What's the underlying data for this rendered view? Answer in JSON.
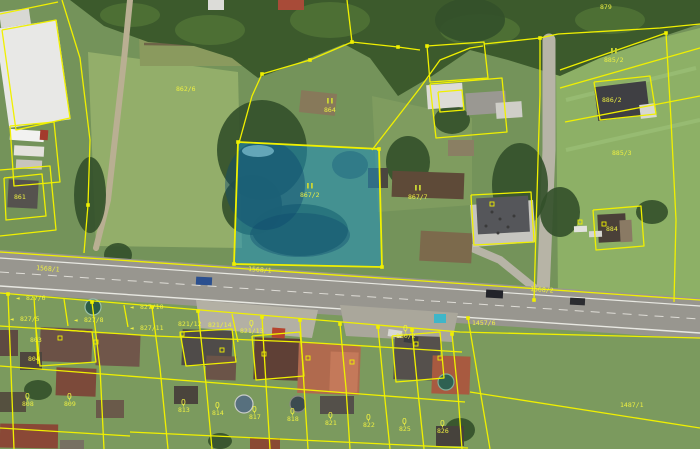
{
  "meta": {
    "view": "aerial-orthophoto-with-cadastral-overlay",
    "width": 700,
    "height": 449
  },
  "map": {
    "w": 700,
    "h": 449,
    "base": "#74935a",
    "palette": {
      "cadastral_yellow": "#f0f000",
      "highlight_blue": "#1d8fc0",
      "label_yellow": "#eef041",
      "symbol_green": "#c9d435",
      "road_gray": "#98968f"
    },
    "fields": [
      {
        "pts": "88,52 238,72 242,248 96,246",
        "fill": "#93ae6a"
      },
      {
        "pts": "556,64 700,28 700,300 558,300",
        "fill": "#8db066"
      },
      {
        "pts": "460,338 700,340 700,449 486,449",
        "fill": "#80ad5a"
      },
      {
        "pts": "0,290 700,336 700,449 0,449",
        "fill": "#7b9a5e"
      },
      {
        "pts": "372,96 472,118 472,205 378,212",
        "fill": "#7f9c5f"
      },
      {
        "pts": "138,0 290,0 290,66 140,66",
        "fill": "#8a9a5e"
      }
    ],
    "strips": [
      {
        "pts": "142,10 288,16",
        "stroke": "#6e6448",
        "w": 2.5
      },
      {
        "pts": "142,26 288,30",
        "stroke": "#6e6448",
        "w": 2.5
      },
      {
        "pts": "144,44 288,46",
        "stroke": "#6e6448",
        "w": 2.5
      },
      {
        "pts": "566,100 696,68",
        "stroke": "#97bb72",
        "w": 4
      },
      {
        "pts": "566,150 700,120",
        "stroke": "#97bb72",
        "w": 4
      }
    ],
    "paths": [
      {
        "pts": "130,0 124,60 116,130 108,200 96,248",
        "stroke": "#b9af92",
        "w": 6
      },
      {
        "pts": "549,40 549,150 543,295",
        "stroke": "#b7b4a6",
        "w": 13
      },
      {
        "pts": "543,295 500,260 472,248",
        "stroke": "#b7b4a6",
        "w": 8
      }
    ],
    "forest": {
      "pts": "70,0 700,0 700,24 652,40 600,58 560,76 508,60 470,50 432,76 398,96 370,58 344,44 300,62 258,78 232,58 194,46 148,42 104,26",
      "fill": "#3c5a2c",
      "canopy": [
        [
          130,
          15,
          30,
          12
        ],
        [
          210,
          30,
          35,
          15
        ],
        [
          330,
          20,
          40,
          18
        ],
        [
          480,
          30,
          40,
          16
        ],
        [
          610,
          20,
          35,
          14
        ]
      ],
      "blobs": [
        [
          262,
          150,
          45,
          50
        ],
        [
          300,
          230,
          48,
          26
        ],
        [
          252,
          205,
          30,
          30
        ],
        [
          408,
          162,
          22,
          26
        ],
        [
          452,
          120,
          18,
          14
        ],
        [
          520,
          185,
          28,
          42
        ],
        [
          560,
          212,
          20,
          25
        ],
        [
          470,
          20,
          35,
          22
        ],
        [
          90,
          195,
          16,
          38
        ],
        [
          118,
          255,
          14,
          12
        ],
        [
          420,
          310,
          25,
          14
        ],
        [
          340,
          302,
          15,
          9
        ],
        [
          460,
          430,
          15,
          12
        ],
        [
          220,
          441,
          12,
          8
        ],
        [
          38,
          390,
          14,
          10
        ],
        [
          652,
          212,
          16,
          12
        ]
      ]
    },
    "road": {
      "pts": "0,250 700,298 700,339 0,293",
      "fill": "#98968f",
      "lines": [
        {
          "pts": "0,258 700,306",
          "color": "#e8e8e2",
          "w": 1.2
        },
        {
          "pts": "0,286 700,333",
          "color": "#e8e8e2",
          "w": 1.4
        },
        {
          "pts": "0,272 700,319",
          "color": "#dedcd6",
          "w": 1,
          "dash": "9,7"
        }
      ]
    },
    "pavements": [
      {
        "pts": "196,300 318,310 312,338 200,328",
        "fill": "#b3b0a4"
      },
      {
        "pts": "340,305 458,313 452,342 346,336",
        "fill": "#aaa79b"
      },
      {
        "pts": "470,205 533,200 536,242 473,247",
        "fill": "#c6c5c0"
      }
    ],
    "soil": [
      [
        420,
        232,
        52,
        30,
        "#7c6a4c",
        3
      ],
      [
        300,
        92,
        36,
        22,
        "#87795a",
        6
      ],
      [
        448,
        140,
        26,
        16,
        "#8a7f63",
        0
      ]
    ],
    "buildings": [
      [
        2,
        24,
        62,
        100,
        "#e8e8e6",
        -8
      ],
      [
        0,
        10,
        30,
        16,
        "#d8d8d4",
        -8
      ],
      [
        8,
        180,
        30,
        28,
        "#55524e",
        3
      ],
      [
        278,
        0,
        26,
        10,
        "#a84b38",
        0
      ],
      [
        208,
        0,
        16,
        10,
        "#dcdcd8",
        0
      ],
      [
        427,
        84,
        36,
        24,
        "#dddcd6",
        -4
      ],
      [
        466,
        92,
        40,
        22,
        "#9a9892",
        -4
      ],
      [
        496,
        102,
        26,
        16,
        "#cfcec8",
        -4
      ],
      [
        368,
        168,
        20,
        20,
        "#4a463f",
        0
      ],
      [
        392,
        172,
        72,
        26,
        "#5e4a38",
        2
      ],
      [
        477,
        197,
        52,
        36,
        "#55565a",
        -3
      ],
      [
        596,
        84,
        52,
        34,
        "#3f3f43",
        -7
      ],
      [
        640,
        104,
        16,
        14,
        "#d8d8d2",
        -7
      ],
      [
        598,
        214,
        28,
        28,
        "#4a4038",
        -3
      ],
      [
        620,
        220,
        12,
        22,
        "#8a7a64",
        -3
      ],
      [
        40,
        328,
        52,
        34,
        "#6b5146",
        2
      ],
      [
        0,
        330,
        18,
        26,
        "#5e4a42",
        0
      ],
      [
        96,
        334,
        44,
        32,
        "#70564a",
        2
      ],
      [
        56,
        368,
        40,
        28,
        "#7c4a3a",
        2
      ],
      [
        20,
        352,
        22,
        18,
        "#4e463e",
        0
      ],
      [
        182,
        330,
        50,
        36,
        "#4f4b49",
        2
      ],
      [
        206,
        356,
        30,
        24,
        "#6b5448",
        2
      ],
      [
        254,
        338,
        46,
        42,
        "#5f4036",
        2
      ],
      [
        298,
        344,
        62,
        50,
        "#b06a4e",
        2
      ],
      [
        330,
        352,
        28,
        40,
        "#c4795a",
        2
      ],
      [
        394,
        336,
        46,
        44,
        "#55504c",
        2
      ],
      [
        432,
        356,
        38,
        38,
        "#a85a40",
        2
      ],
      [
        174,
        386,
        24,
        18,
        "#4a443c",
        0
      ],
      [
        320,
        396,
        34,
        18,
        "#54504a",
        0
      ],
      [
        250,
        438,
        30,
        11,
        "#8a4a34",
        0
      ],
      [
        436,
        426,
        28,
        20,
        "#46423c",
        0
      ],
      [
        96,
        400,
        28,
        18,
        "#6a5a4a",
        0
      ],
      [
        0,
        392,
        26,
        20,
        "#55503f",
        0
      ],
      [
        0,
        424,
        58,
        24,
        "#8a4836",
        1
      ],
      [
        60,
        440,
        24,
        9,
        "#777062",
        0
      ],
      [
        272,
        328,
        13,
        10,
        "#b5442e",
        4
      ],
      [
        434,
        314,
        12,
        9,
        "#3fb6c9",
        0
      ]
    ],
    "circles": [
      [
        93,
        307,
        8,
        "#2e5d46",
        "#9ac0a8"
      ],
      [
        244,
        404,
        9,
        "#57707e",
        "#c9ccc9"
      ],
      [
        298,
        404,
        8,
        "#3c4a50",
        "#888880"
      ],
      [
        446,
        382,
        8,
        "#2f6152",
        "#7fae99"
      ]
    ],
    "vehicles": [
      [
        196,
        277,
        16,
        8,
        "#2a4f8f",
        3
      ],
      [
        486,
        290,
        17,
        8,
        "#23242a",
        3
      ],
      [
        570,
        298,
        15,
        7,
        "#2b2c30",
        3
      ],
      [
        388,
        330,
        14,
        7,
        "#d8d8d4",
        8
      ],
      [
        404,
        336,
        14,
        7,
        "#3a3b40",
        8
      ],
      [
        574,
        226,
        13,
        6,
        "#e2e2de",
        -2
      ],
      [
        589,
        231,
        13,
        6,
        "#d6d6d0",
        -2
      ],
      [
        10,
        130,
        34,
        11,
        "#f2f2f0",
        4
      ],
      [
        14,
        146,
        30,
        10,
        "#e4e2dc",
        3
      ],
      [
        16,
        160,
        26,
        9,
        "#c8c4bc",
        3
      ],
      [
        40,
        130,
        8,
        10,
        "#a33b2c",
        4
      ]
    ],
    "people": [
      [
        492,
        212
      ],
      [
        500,
        219
      ],
      [
        508,
        227
      ],
      [
        514,
        216
      ],
      [
        498,
        233
      ],
      [
        486,
        226
      ]
    ],
    "highlight": {
      "pts": "238,142 379,149 382,267 234,264",
      "fill": "#1d8fc0",
      "opacity": 0.55,
      "stroke": "#f0f000",
      "blobs": [
        [
          265,
          185,
          40,
          45,
          "#0e4a6e",
          0.45
        ],
        [
          300,
          235,
          50,
          22,
          "#0e4a6e",
          0.4
        ],
        [
          350,
          165,
          18,
          14,
          "#0f5478",
          0.35
        ],
        [
          258,
          151,
          16,
          6,
          "#9fe0ee",
          0.55
        ]
      ]
    },
    "cadastral": {
      "color": "#f0f000",
      "width": 1.3,
      "lines": [
        "62,0 80,58 90,140 88,205 84,253",
        "0,14 58,2",
        "2,30 56,20 70,118 16,130 2,30",
        "10,126 54,122 60,182 14,186 10,126",
        "0,170 50,166 56,230 0,236",
        "4,178 42,174 46,216 6,220 4,178",
        "0,252 700,300",
        "0,293 460,332 700,338",
        "239,143 252,96 262,74 310,60 352,42 398,47 420,50",
        "372,150 420,88 440,60 470,48 483,46",
        "352,42 347,0",
        "427,46 484,42 488,78 430,82 427,46",
        "430,84 502,78 507,132 436,138 430,84",
        "438,92 462,90 464,110 440,112 438,92",
        "484,44 540,38 558,34",
        "540,38 540,95 538,160 536,230 534,300",
        "558,34 660,28 700,24",
        "560,70 666,33",
        "560,88 700,48",
        "666,33 671,120 676,220 674,302",
        "565,122 700,96",
        "594,82 650,76 656,114 600,120 594,82",
        "593,210 641,206 644,246 596,250 593,210",
        "471,195 531,192 534,242 474,245 471,195",
        "8,294 14,449",
        "34,297 38,364",
        "64,299 68,326",
        "92,302 100,368 104,449",
        "124,305 128,327",
        "152,307 160,368 168,449",
        "198,311 206,384 212,449",
        "232,314 238,342",
        "262,317 266,384 270,449",
        "300,320 304,386 308,449",
        "340,324 346,388 350,449",
        "378,327 384,390 390,449",
        "412,330 418,392 424,449",
        "452,334 458,394 462,449",
        "468,318 480,390 490,449",
        "0,326 155,336 300,342 462,352",
        "0,366 230,384 465,402",
        "0,428 130,436",
        "130,432 300,440 468,448",
        "470,392 700,428",
        "180,332 232,329 236,362 186,366 180,332",
        "252,336 300,332 304,376 256,380 252,336",
        "392,336 440,332 444,378 396,382 392,336",
        "36,328 92,332 96,362 40,366 36,328"
      ],
      "vertices": [
        [
          238,
          142
        ],
        [
          379,
          149
        ],
        [
          382,
          267
        ],
        [
          234,
          264
        ],
        [
          262,
          74
        ],
        [
          310,
          60
        ],
        [
          352,
          42
        ],
        [
          398,
          47
        ],
        [
          427,
          46
        ],
        [
          540,
          38
        ],
        [
          666,
          33
        ],
        [
          88,
          205
        ],
        [
          8,
          294
        ],
        [
          92,
          302
        ],
        [
          152,
          307
        ],
        [
          198,
          311
        ],
        [
          262,
          317
        ],
        [
          300,
          320
        ],
        [
          340,
          324
        ],
        [
          378,
          327
        ],
        [
          412,
          330
        ],
        [
          452,
          334
        ],
        [
          468,
          318
        ],
        [
          534,
          300
        ]
      ],
      "marks": [
        [
          222,
          350
        ],
        [
          264,
          354
        ],
        [
          308,
          358
        ],
        [
          352,
          362
        ],
        [
          440,
          358
        ],
        [
          96,
          342
        ],
        [
          60,
          338
        ],
        [
          182,
          334
        ],
        [
          416,
          344
        ],
        [
          580,
          222
        ],
        [
          604,
          224
        ],
        [
          492,
          204
        ]
      ]
    },
    "label_style": {
      "fill": "#eef041",
      "sym_fill": "#c9d435",
      "size": 6.5
    },
    "labels": [
      {
        "t": "879",
        "x": 600,
        "y": 9
      },
      {
        "sym": "II",
        "t": "885/2",
        "x": 604,
        "y": 62
      },
      {
        "t": "886/2",
        "x": 602,
        "y": 102
      },
      {
        "t": "885/3",
        "x": 612,
        "y": 155
      },
      {
        "t": "884",
        "x": 606,
        "y": 231
      },
      {
        "t": "862/6",
        "x": 176,
        "y": 91
      },
      {
        "sym": "II",
        "t": "864",
        "x": 324,
        "y": 112
      },
      {
        "sym": "II",
        "t": "867/2",
        "x": 300,
        "y": 197
      },
      {
        "sym": "II",
        "t": "867/7",
        "x": 408,
        "y": 199
      },
      {
        "t": "861",
        "x": 14,
        "y": 199
      },
      {
        "t": "1568/1",
        "x": 36,
        "y": 270,
        "rot": 4
      },
      {
        "t": "1568/1",
        "x": 248,
        "y": 271,
        "rot": 4
      },
      {
        "t": "1568/2",
        "x": 530,
        "y": 291,
        "rot": 4
      },
      {
        "t": "1457/6",
        "x": 472,
        "y": 325
      },
      {
        "sym": "Q",
        "t": "830/2",
        "x": 396,
        "y": 338
      },
      {
        "sym": "arrow",
        "t": "827/6",
        "x": 26,
        "y": 300
      },
      {
        "sym": "arrow",
        "t": "827/5",
        "x": 20,
        "y": 321
      },
      {
        "sym": "arrow",
        "t": "827/8",
        "x": 84,
        "y": 322
      },
      {
        "sym": "arrow",
        "t": "827/10",
        "x": 140,
        "y": 309
      },
      {
        "sym": "arrow",
        "t": "827/11",
        "x": 140,
        "y": 330
      },
      {
        "t": "821/12",
        "x": 178,
        "y": 326
      },
      {
        "t": "821/14",
        "x": 208,
        "y": 327
      },
      {
        "sym": "Q",
        "t": "821/13",
        "x": 240,
        "y": 333
      },
      {
        "t": "803",
        "x": 30,
        "y": 342
      },
      {
        "t": "804",
        "x": 28,
        "y": 361
      },
      {
        "sym": "Q",
        "t": "808",
        "x": 22,
        "y": 406
      },
      {
        "sym": "Q",
        "t": "809",
        "x": 64,
        "y": 406
      },
      {
        "sym": "Q",
        "t": "813",
        "x": 178,
        "y": 412
      },
      {
        "sym": "Q",
        "t": "814",
        "x": 212,
        "y": 415
      },
      {
        "sym": "Q",
        "t": "817",
        "x": 249,
        "y": 419
      },
      {
        "sym": "Q",
        "t": "818",
        "x": 287,
        "y": 421
      },
      {
        "sym": "Q",
        "t": "821",
        "x": 325,
        "y": 425
      },
      {
        "sym": "Q",
        "t": "822",
        "x": 363,
        "y": 427
      },
      {
        "sym": "Q",
        "t": "825",
        "x": 399,
        "y": 431
      },
      {
        "sym": "Q",
        "t": "826",
        "x": 437,
        "y": 433
      },
      {
        "t": "1487/1",
        "x": 620,
        "y": 407
      }
    ]
  }
}
